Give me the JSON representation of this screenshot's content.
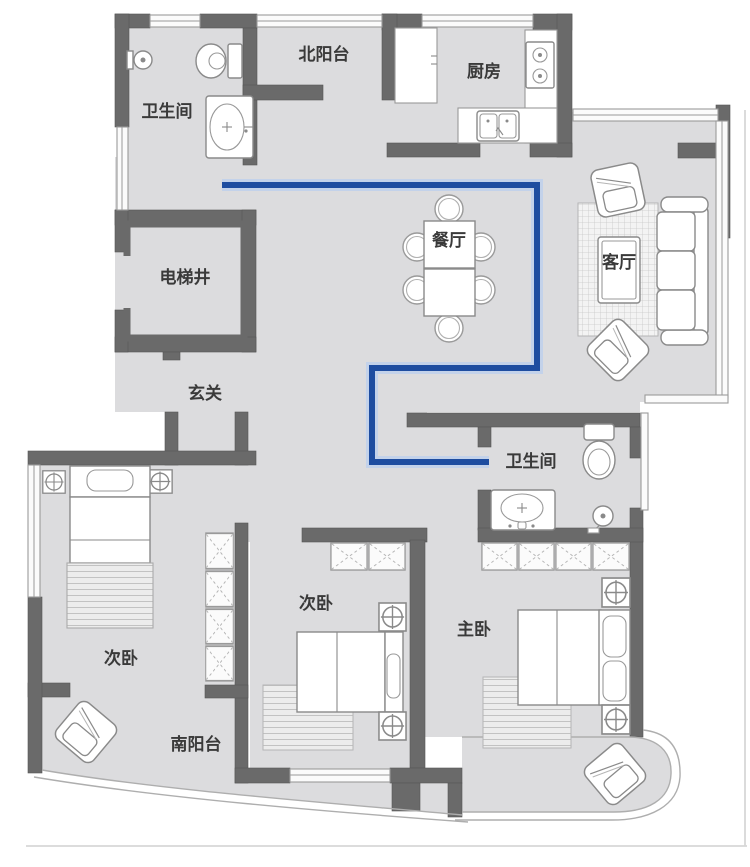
{
  "title": "apartment-floor-plan",
  "rooms": {
    "bathroom_north": {
      "label": "卫生间"
    },
    "north_balcony": {
      "label": "北阳台"
    },
    "kitchen": {
      "label": "厨房"
    },
    "dining_room": {
      "label": "餐厅"
    },
    "living_room": {
      "label": "客厅"
    },
    "elevator_shaft": {
      "label": "电梯井"
    },
    "entrance": {
      "label": "玄关"
    },
    "bathroom_south": {
      "label": "卫生间"
    },
    "bedroom_left": {
      "label": "次卧"
    },
    "bedroom_middle": {
      "label": "次卧"
    },
    "master_bedroom": {
      "label": "主卧"
    },
    "south_balcony": {
      "label": "南阳台"
    }
  },
  "route": {
    "description": "blue plumbing/walk route from north bathroom to south bathroom",
    "color": "#1e4da0",
    "halo_color": "#c3d2ea",
    "points": [
      [
        222,
        185
      ],
      [
        537,
        185
      ],
      [
        537,
        368
      ],
      [
        372,
        368
      ],
      [
        372,
        462
      ],
      [
        489,
        462
      ]
    ]
  },
  "colors": {
    "wall": "#6a6a6a",
    "floor": "#dcdcde",
    "furniture_stroke": "#8a8a8a",
    "label_text": "#3a3a3a",
    "background": "#ffffff"
  },
  "furniture_icons": [
    "toilet-icon",
    "sink-icon",
    "shower-icon",
    "stove-icon",
    "fridge-icon",
    "dining-table",
    "dining-chair",
    "sofa",
    "armchair",
    "coffee-table",
    "rug",
    "bed",
    "pillow",
    "nightstand-lamp",
    "wardrobe-cell"
  ]
}
